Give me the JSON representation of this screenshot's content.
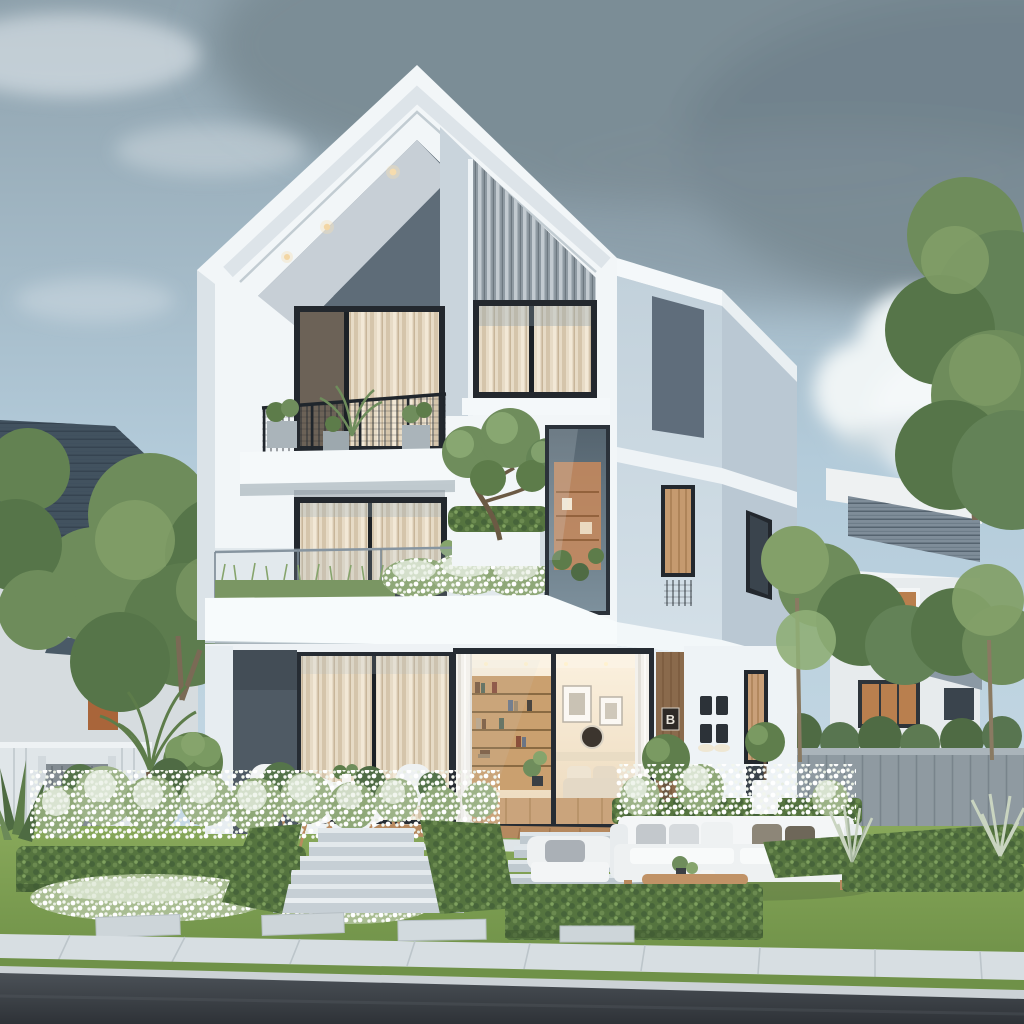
{
  "scene": {
    "setting": "suburban street, daytime, partly cloudy sky with dark cloud bank upper right",
    "main_house": {
      "storeys": 3,
      "style": "modern white gable volume with flat-roof blue-gray side wing",
      "house_number_plaque": "B",
      "level3_features": [
        "recessed gable porch with 3 soffit downlights",
        "black mesh balcony railing with potted plants and palm",
        "two curtained windows",
        "gray vertical slat siding panel"
      ],
      "level2_features": [
        "curtained sliding door",
        "glass-balustrade terrace",
        "trailing planter row",
        "white flowering hedge",
        "white planter box with clipped hedge",
        "bonsai tree",
        "corner glass window with warm interior"
      ],
      "level1_features": [
        "living room behind glass sliding doors",
        "bookshelf wall",
        "framed art and round mirror",
        "cream curtain doors",
        "dark accent wall",
        "wood entry strip with number plaque",
        "four square wall sconces",
        "narrow slot window",
        "wood deck patio"
      ]
    },
    "neighbor_left": {
      "roof": "dark slate pitched roof",
      "walls": "light gray",
      "details": [
        "wood framed window",
        "wood door",
        "small awning roof",
        "large green canopy trees",
        "palm fronds"
      ]
    },
    "neighbor_right": {
      "roof": "gray shingle slopes",
      "walls": "white",
      "details": [
        "wood framed windows with curtains",
        "white parapet band",
        "gray board fence",
        "tall slender trees"
      ]
    },
    "garden": {
      "front_beds": [
        "terraced boxwood hedges",
        "white hydrangea bushes",
        "white groundcover mounds",
        "ball topiary trees",
        "agave rosette",
        "silver ornamental grasses"
      ],
      "lawn": "manicured lawn with rectangular stepping stones",
      "stairs": "two concrete stair flights separated by hedge wedge"
    },
    "furniture": {
      "patio_dining": {
        "white_shell_chairs": 4,
        "table": 1,
        "centerpiece": "green plant"
      },
      "terrace_lounge": {
        "three_seat_sofa": 1,
        "armchair": 1,
        "wood_coffee_table": 1,
        "pillow_colors": [
          "white",
          "light gray",
          "taupe",
          "dark taupe"
        ]
      }
    },
    "street": [
      "concrete sidewalk with seams",
      "grass verge",
      "light curb",
      "asphalt road"
    ]
  },
  "palette": {
    "sky_top": "#8ea1ac",
    "sky_mid": "#b3cbda",
    "sky_low": "#cfe0ea",
    "storm_cloud": "#7a8b95",
    "cloud_white": "#eff4f5",
    "house_white": "#f2f6f8",
    "soffit_shadow": "#dbe3e8",
    "gable_dark": "#5e6c78",
    "porch_ceiling": "#c7cfd6",
    "downlight": "#f6dcae",
    "slat_base": "#8f9aa2",
    "slat_stripe": "#c2cad0",
    "column_gray": "#c9d4dc",
    "window_frame": "#23282e",
    "curtain_light": "#e7dbc6",
    "curtain_dark": "#d5c5ab",
    "wing_front": "#ccd9e2",
    "wing_side": "#bac8d3",
    "accent_panel": "#5f6d7b",
    "glass_tint": "#a9bcc9",
    "corner_glass_top": "#55646f",
    "corner_glass_bottom": "#7d909c",
    "interior_wall": "#f3e6d2",
    "interior_wood": "#caa06f",
    "interior_floor": "#caa47c",
    "dark_wall": "#4f5a64",
    "wood_wall": "#8a6a4c",
    "plaque_bg": "#2e2a26",
    "plaque_text": "#e8e4da",
    "sconce": "#2c3238",
    "tree_green": "#6e8c5b",
    "tree_dark": "#567549",
    "tree_light": "#83a069",
    "hedge_green": "#55743f",
    "lawn_top": "#88a85a",
    "lawn_bottom": "#6f9148",
    "flower_base": "#8fa878",
    "flower_light": "#ebf1e7",
    "roof_slate": "#42525f",
    "roof_gray": "#7f8d99",
    "neighbor_wall_left": "#d6dcdf",
    "neighbor_wall_right": "#e7ebed",
    "wood_window": "#b97f4e",
    "fence_left": "#e0e6e9",
    "gate_gray": "#838c92",
    "fence_right": "#8f9aa1",
    "stair_top": "#e3e9ec",
    "stair_riser": "#c6cfd5",
    "sofa_white": "#eef1f2",
    "pillow_gray": "#aab0b6",
    "pillow_taupe": "#8d8678",
    "pillow_dark": "#6e6759",
    "table_wood": "#c09266",
    "deck_wood": "#b5895f",
    "sidewalk": "#d7dee2",
    "curb": "#ccd2d6",
    "road_top": "#4b5157",
    "road_bottom": "#2e3237"
  }
}
